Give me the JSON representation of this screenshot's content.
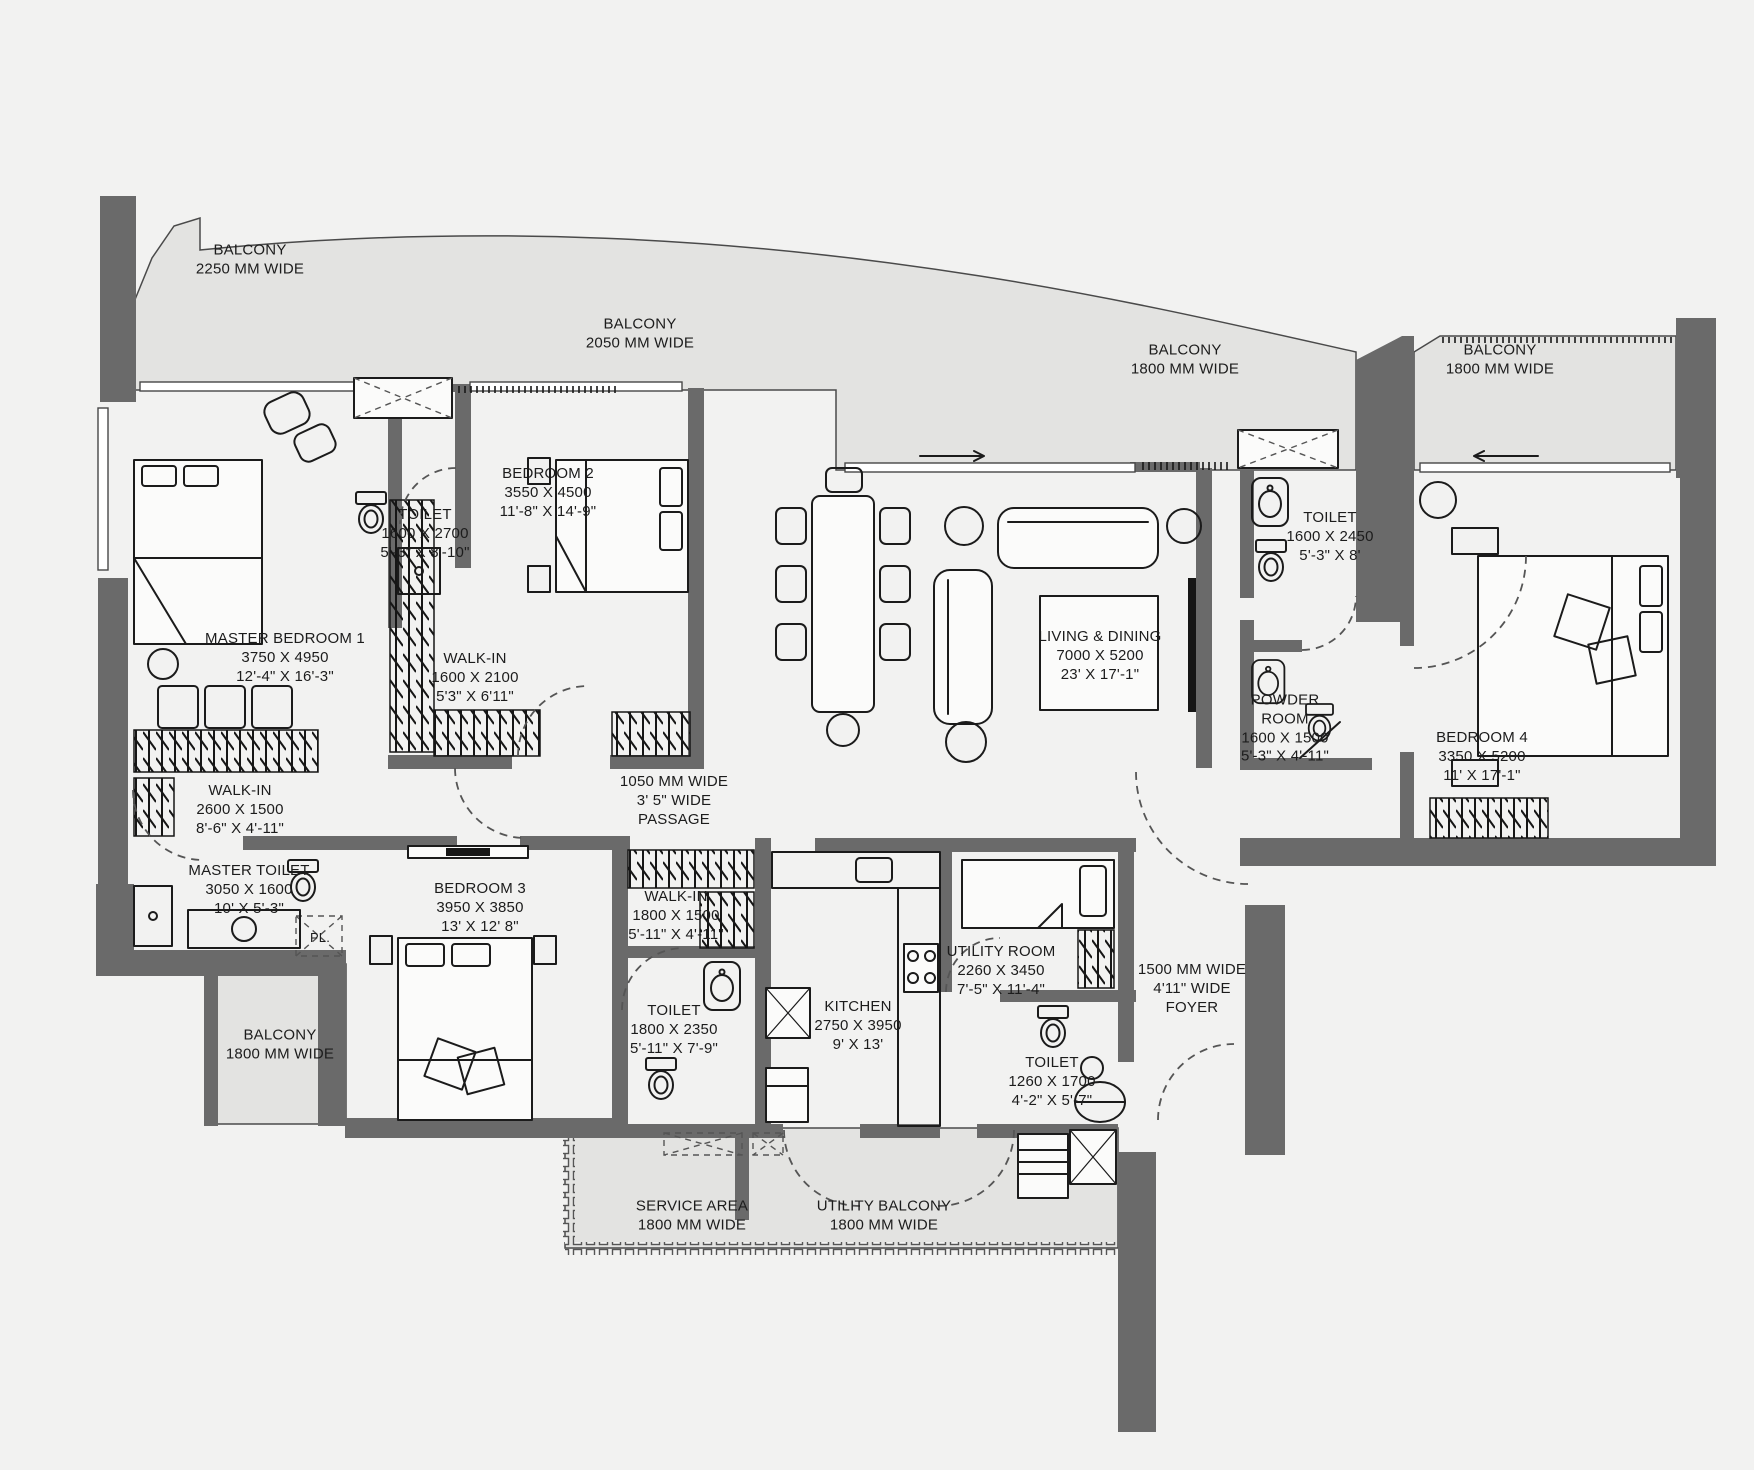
{
  "plan": {
    "title": "4 BHK Apartment Floor Plan",
    "colors": {
      "background": "#f2f2f1",
      "balcony": "#e3e3e1",
      "wall": "#6a6a6a",
      "line": "#1b1b1b"
    },
    "labels": [
      {
        "id": "balcony-top-left",
        "lines": [
          "BALCONY",
          "2250 MM WIDE"
        ]
      },
      {
        "id": "balcony-top-mid",
        "lines": [
          "BALCONY",
          "2050 MM WIDE"
        ]
      },
      {
        "id": "balcony-top-right-1",
        "lines": [
          "BALCONY",
          "1800 MM WIDE"
        ]
      },
      {
        "id": "balcony-top-right-2",
        "lines": [
          "BALCONY",
          "1800 MM WIDE"
        ]
      },
      {
        "id": "master-bedroom-1",
        "lines": [
          "MASTER BEDROOM 1",
          "3750 X 4950",
          "12'-4\" X 16'-3\""
        ]
      },
      {
        "id": "toilet-1",
        "lines": [
          "TOILET",
          "1600 X 2700",
          "5'-3\" X 8'-10\""
        ]
      },
      {
        "id": "bedroom-2",
        "lines": [
          "BEDROOM 2",
          "3550 X 4500",
          "11'-8\" X 14'-9\""
        ]
      },
      {
        "id": "walk-in-1",
        "lines": [
          "WALK-IN",
          "1600 X 2100",
          "5'3\" X 6'11\""
        ]
      },
      {
        "id": "living-dining",
        "lines": [
          "LIVING & DINING",
          "7000 X 5200",
          "23' X 17'-1\""
        ]
      },
      {
        "id": "toilet-2",
        "lines": [
          "TOILET",
          "1600 X 2450",
          "5'-3\" X 8'"
        ]
      },
      {
        "id": "powder-room",
        "lines": [
          "POWDER",
          "ROOM",
          "1600 X 1500",
          "5'-3\" X 4'-11\""
        ]
      },
      {
        "id": "bedroom-4",
        "lines": [
          "BEDROOM 4",
          "3350 X 5200",
          "11' X 17'-1\""
        ]
      },
      {
        "id": "walk-in-2",
        "lines": [
          "WALK-IN",
          "2600 X 1500",
          "8'-6\" X 4'-11\""
        ]
      },
      {
        "id": "passage",
        "lines": [
          "1050 MM WIDE",
          "3' 5\" WIDE",
          "PASSAGE"
        ]
      },
      {
        "id": "master-toilet",
        "lines": [
          "MASTER TOILET",
          "3050 X 1600",
          "10' X 5'-3\""
        ]
      },
      {
        "id": "pl-shaft",
        "lines": [
          "PL."
        ]
      },
      {
        "id": "bedroom-3",
        "lines": [
          "BEDROOM 3",
          "3950 X 3850",
          "13' X 12' 8\""
        ]
      },
      {
        "id": "walk-in-3",
        "lines": [
          "WALK-IN",
          "1800 X 1500",
          "5'-11\" X 4'-11\""
        ]
      },
      {
        "id": "balcony-left",
        "lines": [
          "BALCONY",
          "1800 MM WIDE"
        ]
      },
      {
        "id": "toilet-3",
        "lines": [
          "TOILET",
          "1800 X 2350",
          "5'-11\" X 7'-9\""
        ]
      },
      {
        "id": "kitchen",
        "lines": [
          "KITCHEN",
          "2750 X 3950",
          "9' X 13'"
        ]
      },
      {
        "id": "utility-room",
        "lines": [
          "UTILITY ROOM",
          "2260 X 3450",
          "7'-5\" X 11'-4\""
        ]
      },
      {
        "id": "toilet-4",
        "lines": [
          "TOILET",
          "1260 X 1700",
          "4'-2\" X 5'-7\""
        ]
      },
      {
        "id": "foyer",
        "lines": [
          "1500 MM WIDE",
          "4'11\" WIDE",
          "FOYER"
        ]
      },
      {
        "id": "service-area",
        "lines": [
          "SERVICE AREA",
          "1800 MM WIDE"
        ]
      },
      {
        "id": "utility-balcony",
        "lines": [
          "UTILITY BALCONY",
          "1800 MM WIDE"
        ]
      }
    ]
  }
}
